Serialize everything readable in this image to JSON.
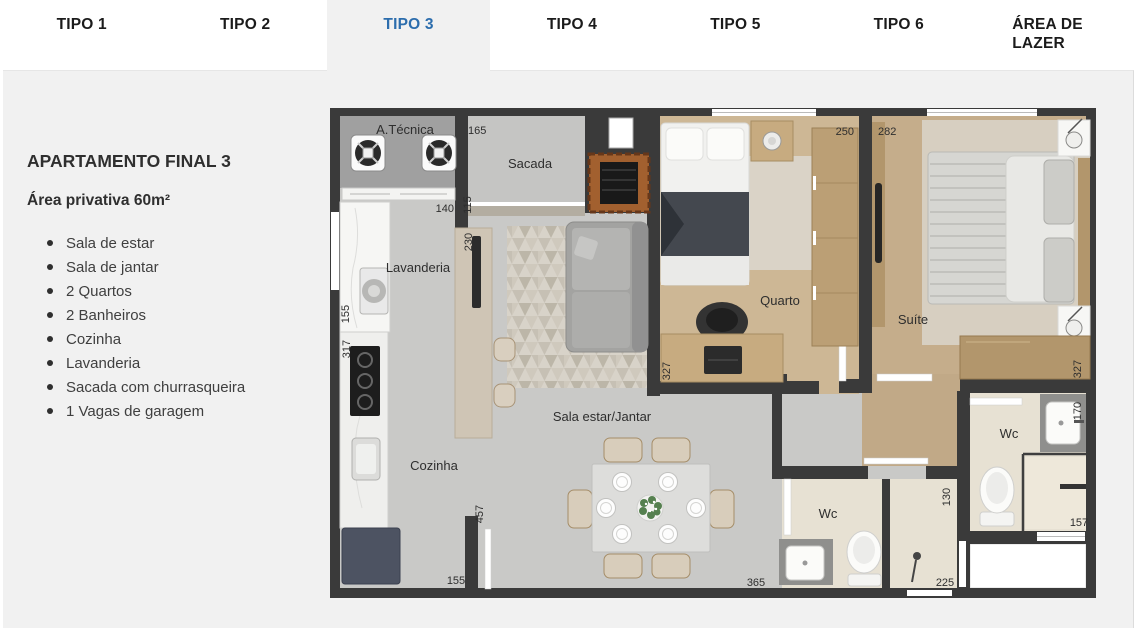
{
  "colors": {
    "accent": "#2c6dad",
    "content_background": "#f1f1f1",
    "tab_text": "#1b1b1b",
    "wall": "#3a3a3a"
  },
  "tabs": [
    {
      "label": "TIPO 1",
      "active": false
    },
    {
      "label": "TIPO 2",
      "active": false
    },
    {
      "label": "TIPO 3",
      "active": true
    },
    {
      "label": "TIPO 4",
      "active": false
    },
    {
      "label": "TIPO 5",
      "active": false
    },
    {
      "label": "TIPO 6",
      "active": false
    },
    {
      "label": "ÁREA DE LAZER",
      "active": false
    }
  ],
  "panel": {
    "title": "APARTAMENTO FINAL 3",
    "subtitle": "Área privativa 60m²",
    "features": [
      "Sala de estar",
      "Sala de jantar",
      "2 Quartos",
      "2 Banheiros",
      "Cozinha",
      "Lavanderia",
      "Sacada com churrasqueira",
      "1 Vagas de garagem"
    ]
  },
  "plan": {
    "rooms": {
      "a_tecnica": "A.Técnica",
      "sacada": "Sacada",
      "lavanderia": "Lavanderia",
      "cozinha": "Cozinha",
      "sala": "Sala estar/Jantar",
      "quarto": "Quarto",
      "suite": "Suíte",
      "wc_suite": "Wc",
      "wc_social": "Wc"
    },
    "dims": {
      "d165": "165",
      "d115": "115",
      "d140": "140",
      "d230": "230",
      "d155_left": "155",
      "d317": "317",
      "d457": "457",
      "d155_bottom": "155",
      "d250": "250",
      "d282": "282",
      "d327_quarto": "327",
      "d327_suite": "327",
      "d170": "170",
      "d130": "130",
      "d157": "157",
      "d365": "365",
      "d225": "225"
    }
  }
}
